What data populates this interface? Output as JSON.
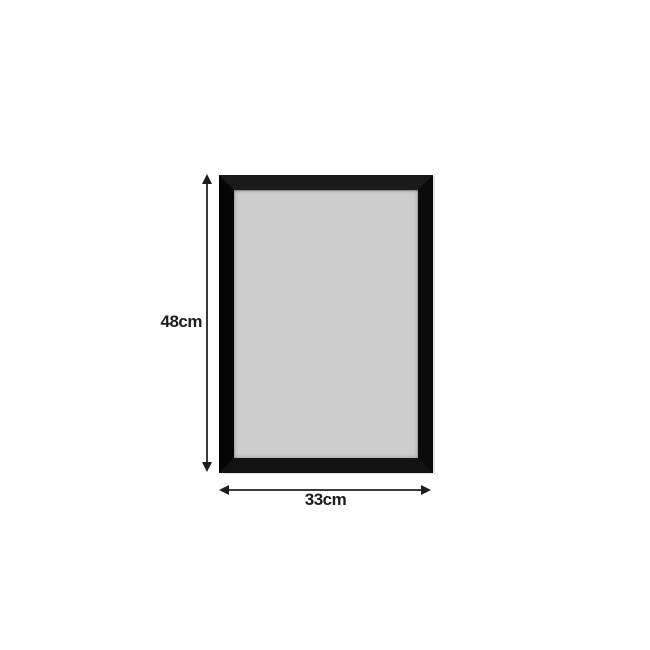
{
  "product_diagram": {
    "background_color": "#ffffff",
    "frame": {
      "type": "rectangular-frame",
      "frame_color": "#0d0d0d",
      "panel_color": "#cdcdcd"
    },
    "dimensions": {
      "height_label": "48cm",
      "width_label": "33cm",
      "annotation_color": "#1e1e1e"
    }
  }
}
